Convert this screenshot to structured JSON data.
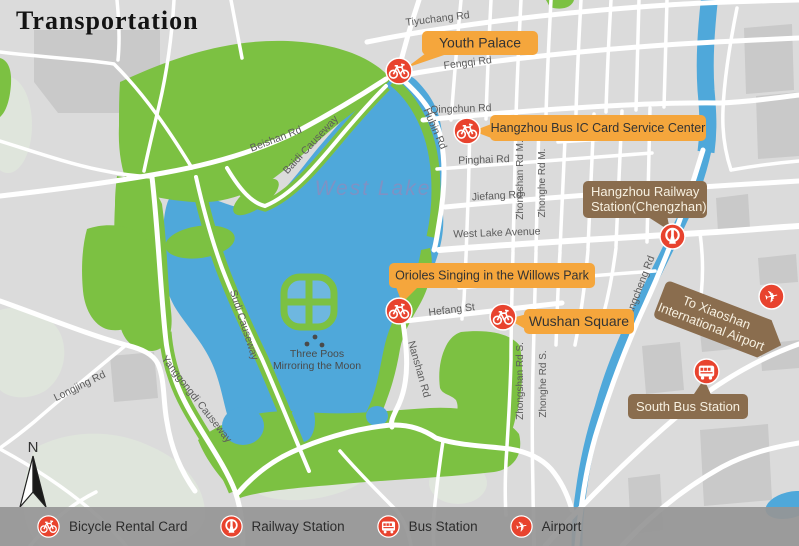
{
  "title": "Transportation",
  "lake_label": "West Lake",
  "island_label_line1": "Three Poos",
  "island_label_line2": "Mirroring the Moon",
  "compass_label": "N",
  "roads": {
    "tiyuchang": "Tiyuchang Rd",
    "fengqi": "Fengqi Rd",
    "qingchun": "Qingchun Rd",
    "pinghai": "Pinghai Rd",
    "jiefang": "Jiefang Rd",
    "west_lake_avenue": "West Lake Avenue",
    "hefang": "Hefang St",
    "hubin": "Hubin Rd",
    "beishan": "Beishan Rd",
    "baidi": "Baidi Causeway",
    "sudi": "Sudi Causeway",
    "yanggongdi": "Yanggongdi Causeway",
    "longjing": "Longjing Rd",
    "nanshan": "Nanshan Rd",
    "zhongshan_m": "Zhongshan Rd M.",
    "zhonghe_m": "Zhonghe Rd M.",
    "zhongshan_s": "Zhongshan Rd S.",
    "zhonghe_s": "Zhonghe Rd S.",
    "jiangcheng": "Jiangcheng Rd"
  },
  "callouts": {
    "youth_palace": "Youth Palace",
    "bus_ic": "Hangzhou Bus IC Card Service Center",
    "railway_line1": "Hangzhou Railway",
    "railway_line2": "Station(Chengzhan)",
    "airport_line1": "To Xiaoshan",
    "airport_line2": "International Airport",
    "orioles": "Orioles Singing in the Willows Park",
    "wushan": "Wushan Square",
    "south_bus": "South Bus Station"
  },
  "legend": {
    "bicycle": "Bicycle Rental Card",
    "railway": "Railway Station",
    "bus": "Bus Station",
    "airport": "Airport"
  },
  "icons": {
    "plane_glyph": "✈"
  },
  "colors": {
    "callout_orange": "#F5A63C",
    "callout_brown": "#8A6D4E",
    "marker_red": "#E8432E",
    "water_blue": "#4FA8DA",
    "park_green": "#7CC142",
    "map_gray": "#DBDBDB"
  }
}
